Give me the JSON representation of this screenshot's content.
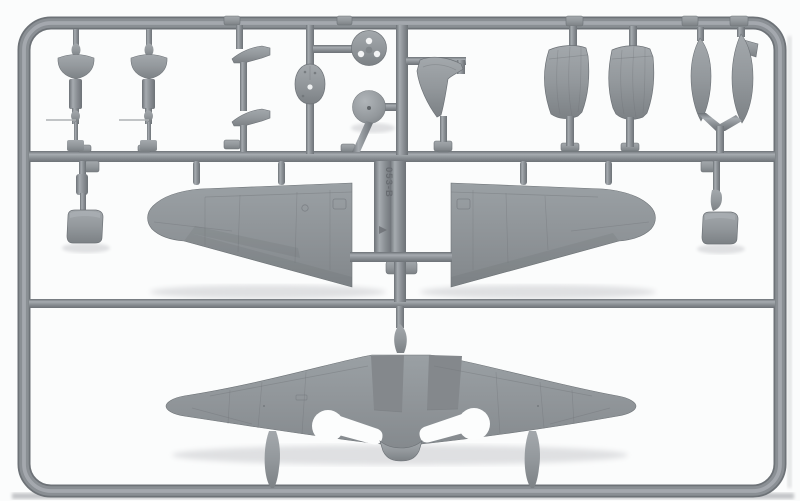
{
  "scene": {
    "type": "photograph",
    "subject": "Injection-moulded grey plastic model-aircraft sprue (runner frame) holding wing halves, a one-piece lower wing, cowling halves, bombs and small fittings",
    "sprue_marking": "053-B",
    "colors": {
      "background": "#fbfcfc",
      "runner_dark": "#6d7277",
      "runner_base": "#8a8f94",
      "runner_light": "#a6abb0",
      "part_light": "#a3a8ac",
      "part_mid": "#93989c",
      "part_dark": "#7c8185",
      "wing_light": "#9aa0a4",
      "wing_mid": "#8f9498",
      "wing_dark": "#82878b",
      "opening_white": "#fcfdfd",
      "marking_text": "#686c71",
      "shadow": "#dfe0e2"
    },
    "parts": [
      "bowl-fairing-1",
      "bowl-fairing-2",
      "intake-wedge-pair",
      "oval-bulkhead",
      "propeller-backplate-disc",
      "spinner-dome",
      "cowl-flap-segment",
      "cowling-half-1",
      "cowling-half-2",
      "bomb-slim",
      "bomb-finned",
      "radiator-box-left",
      "radiator-box-right",
      "upper-wing-left",
      "upper-wing-right",
      "lower-wing-one-piece"
    ]
  }
}
